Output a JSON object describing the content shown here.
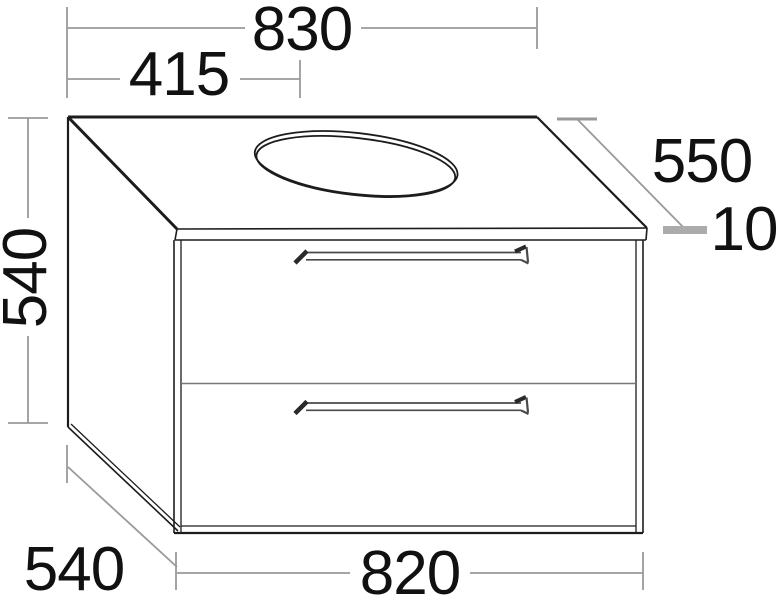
{
  "drawing": {
    "dimensions": {
      "width_top": "830",
      "basin_center": "415",
      "depth_top": "550",
      "countertop_thickness": "10",
      "height_side": "540",
      "depth_bottom": "540",
      "width_bottom": "820"
    },
    "colors": {
      "outline": "#1c1c1c",
      "dimension_line": "#9a9a9a",
      "thick_tick": "#ababab",
      "label_text": "#111111",
      "background": "#ffffff"
    }
  }
}
